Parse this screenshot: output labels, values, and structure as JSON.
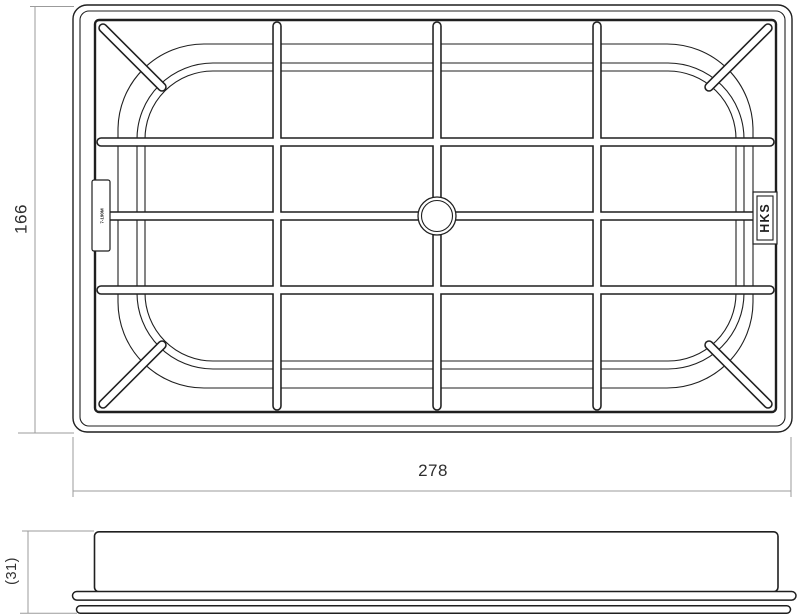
{
  "drawing": {
    "type": "technical-drawing-air-filter",
    "views": {
      "top": {
        "logo_text": "HKS",
        "part_tab_code": "7-190M"
      },
      "side": {}
    },
    "dimensions": {
      "height": "166",
      "width": "278",
      "thickness": "(31)"
    },
    "colors": {
      "line": "#1f1f1f",
      "dimension_line": "#9b9b9b",
      "dimension_text": "#2e2e2e",
      "background": "#ffffff"
    }
  }
}
